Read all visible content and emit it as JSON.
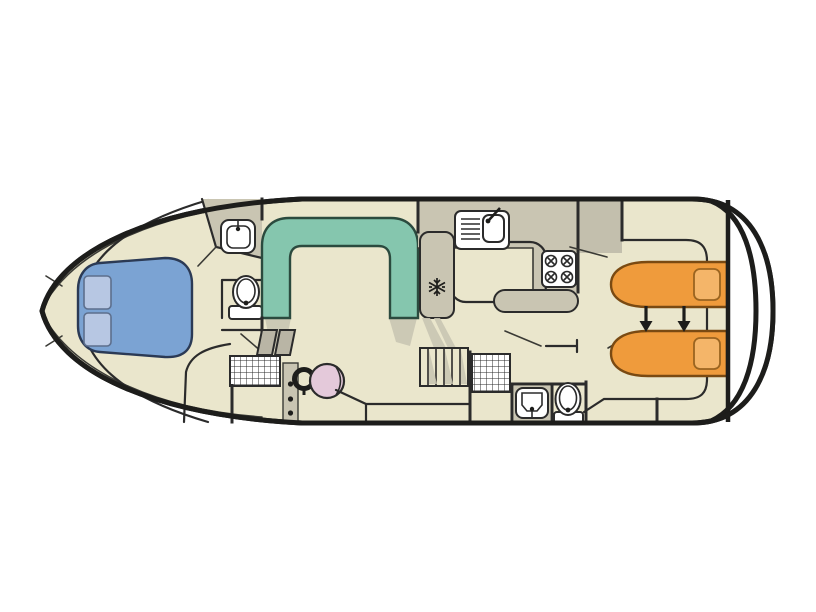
{
  "meta": {
    "description": "Top-view deck plan of a canal cruiser houseboat, no visible text labels",
    "orientation": "bow-left-stern-right"
  },
  "colors": {
    "floor_beige": "#eae6cc",
    "wet_gray": "#c9c5b2",
    "wardrobe_gray": "#c3bfad",
    "pane_gray": "#b9b5a5",
    "sofa_teal": "#85c6ae",
    "bed_blue": "#7ba3d3",
    "pillow_blue": "#b7c7e3",
    "bed_orange": "#ef9b3c",
    "pillow_orange": "#f4b569",
    "seat_pink": "#e4c9da",
    "outline_dark": "#2b2b2b",
    "hull_black": "#1d1d1b",
    "white": "#ffffff"
  },
  "rooms": {
    "bow_cabin": {
      "fixtures": [
        "double-bed",
        "pillow",
        "pillow",
        "washbasin",
        "toilet"
      ]
    },
    "saloon": {
      "fixtures": [
        "u-shaped-sofa"
      ]
    },
    "galley": {
      "fixtures": [
        "sink-with-drainer",
        "stove-4-burners",
        "fridge-snowflake",
        "counter-bar"
      ]
    },
    "helm": {
      "fixtures": [
        "steering-wheel",
        "helm-seat",
        "console",
        "bench",
        "floor-grating",
        "step-panes"
      ]
    },
    "mid_stairs": {
      "fixtures": [
        "companionway-stairs"
      ]
    },
    "aft_bathroom": {
      "fixtures": [
        "shower-grating",
        "washbasin",
        "toilet",
        "door"
      ]
    },
    "aft_cabin": {
      "fixtures": [
        "single-bed",
        "single-bed",
        "pillow",
        "pillow",
        "slide-together-arrows",
        "wardrobe"
      ]
    },
    "stern": {
      "fixtures": [
        "transom-double-curve",
        "aft-deck"
      ]
    }
  },
  "counts": {
    "beds_double": 1,
    "beds_single": 2,
    "toilets": 2,
    "washbasins": 3,
    "showers": 1,
    "stove_burners": 4,
    "arrows": 2
  }
}
